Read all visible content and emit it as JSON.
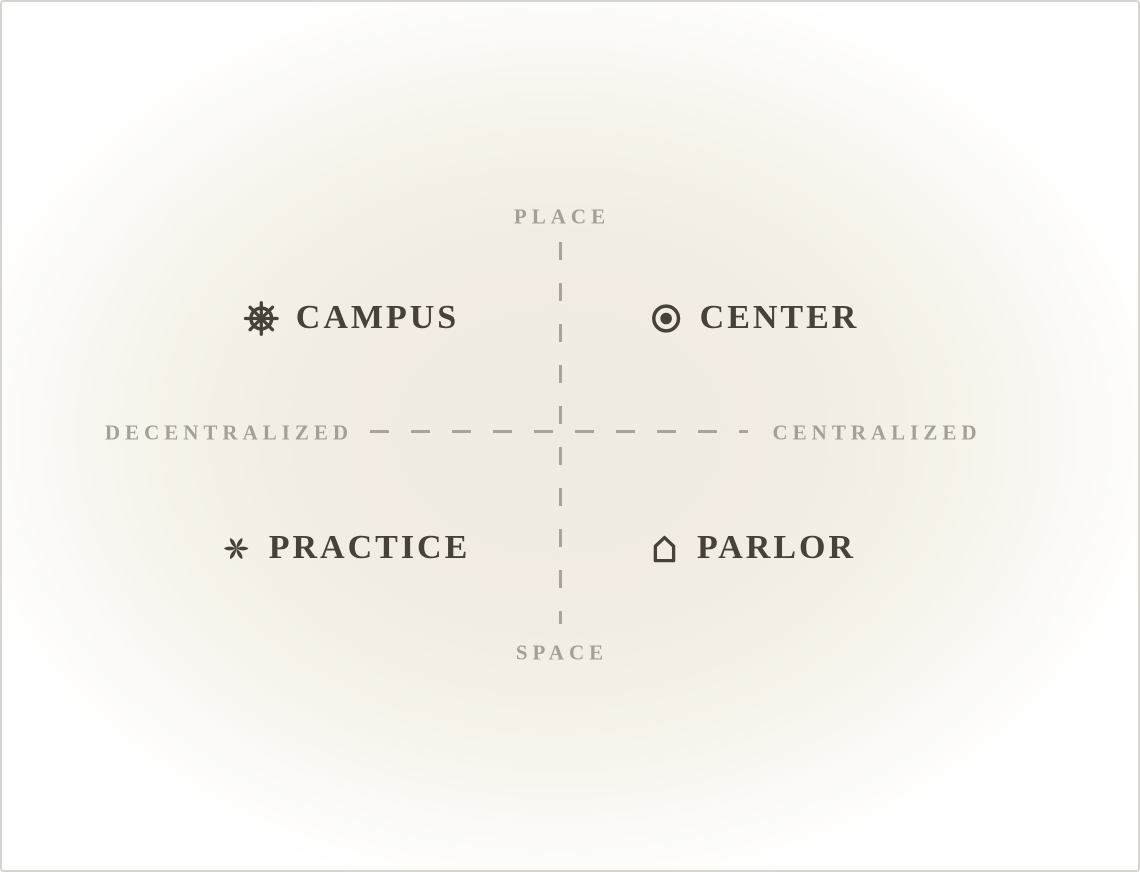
{
  "diagram": {
    "axes": {
      "top_label": "PLACE",
      "bottom_label": "SPACE",
      "left_label": "DECENTRALIZED",
      "right_label": "CENTRALIZED"
    },
    "quadrants": [
      {
        "position": "top-left",
        "icon": "ship-wheel-icon",
        "label": "CAMPUS"
      },
      {
        "position": "top-right",
        "icon": "fisheye-icon",
        "label": "CENTER"
      },
      {
        "position": "bottom-left",
        "icon": "asterisk-icon",
        "label": "PRACTICE"
      },
      {
        "position": "bottom-right",
        "icon": "house-icon",
        "label": "PARLOR"
      }
    ],
    "colors": {
      "item_text": "#46423a",
      "axis_text": "#a5a094",
      "axis_line": "#a8a499",
      "background_center": "#f1ece1",
      "background_edge": "#ffffff",
      "border": "#d6d5d0"
    }
  }
}
